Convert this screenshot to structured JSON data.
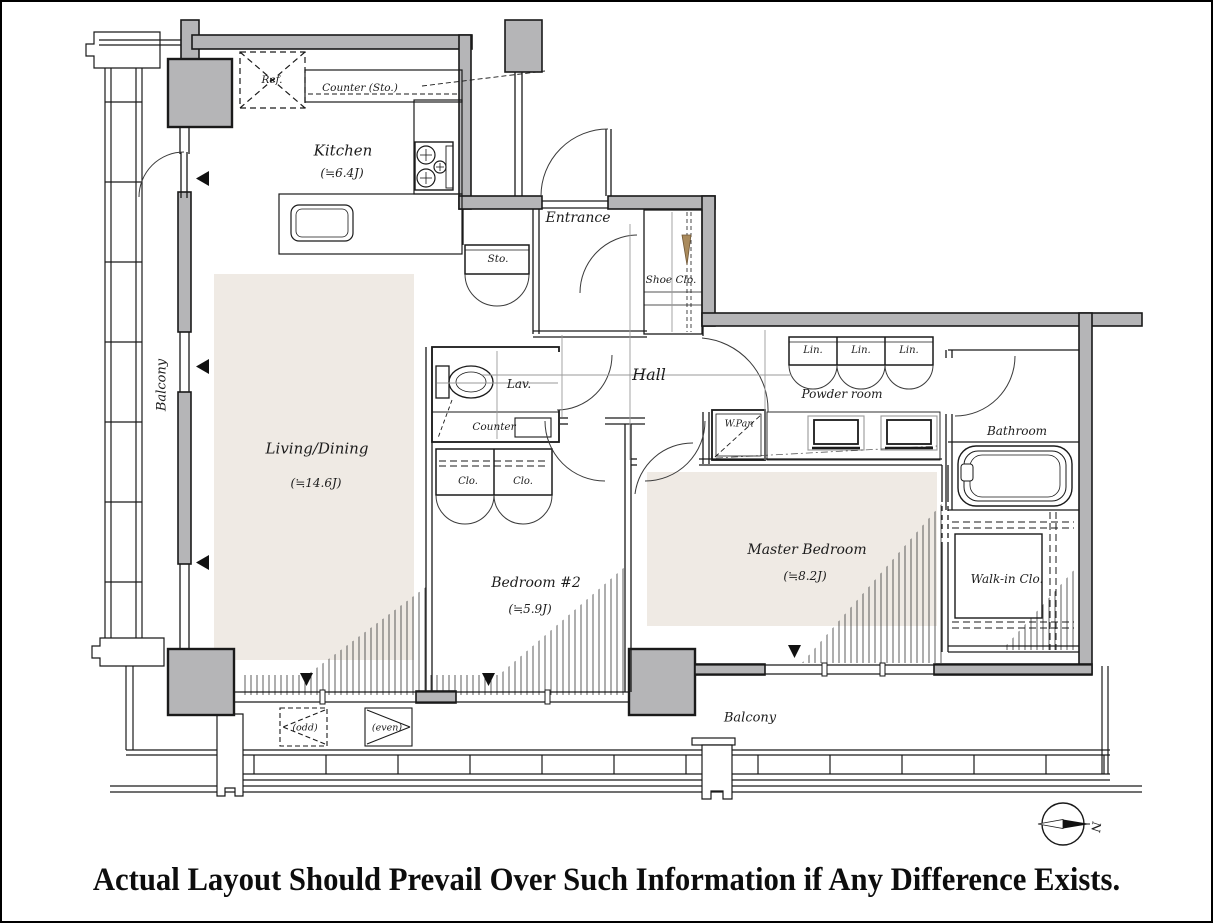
{
  "labels": {
    "kitchen": "Kitchen",
    "kitchen_size": "(≒6.4J)",
    "living_dining": "Living/Dining",
    "living_dining_size": "(≒14.6J)",
    "bedroom2": "Bedroom #2",
    "bedroom2_size": "(≒5.9J)",
    "master_bedroom": "Master Bedroom",
    "master_bedroom_size": "(≒8.2J)",
    "entrance": "Entrance",
    "hall": "Hall",
    "powder_room": "Powder room",
    "bathroom": "Bathroom",
    "walk_in_closet": "Walk-in Clo.",
    "balcony": "Balcony",
    "refrigerator": "Ref.",
    "counter_storage": "Counter (Sto.)",
    "storage": "Sto.",
    "shoe_closet": "Shoe Clo.",
    "lavatory": "Lav.",
    "counter": "Counter",
    "linen": "Lin.",
    "washer_pan": "W.Pan",
    "closet": "Clo.",
    "trunk_odd": "(odd)",
    "trunk_even": "(even)",
    "north": "N"
  },
  "caption": "Actual Layout Should Prevail Over Such Information if Any Difference Exists.",
  "colors": {
    "wall_gray": "#b5b5b7",
    "room_beige": "#efeae4",
    "line": "#1a1a1a",
    "shoe_wedge_tan": "#a98a5c"
  }
}
